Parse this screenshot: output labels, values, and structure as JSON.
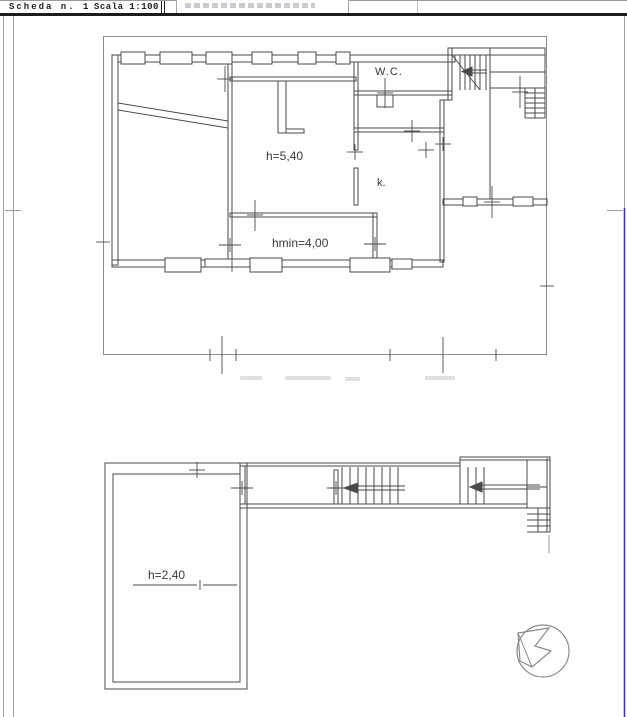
{
  "header": {
    "sheet_label": "Scheda n. 1",
    "scale_label": "Scala 1:100"
  },
  "upper_plan": {
    "title": "main floor plan",
    "labels": [
      {
        "id": "wc",
        "text": "W.C."
      },
      {
        "id": "height",
        "text": "h=5,40"
      },
      {
        "id": "kitchen",
        "text": "k."
      },
      {
        "id": "min_height",
        "text": "hmin=4,00"
      }
    ]
  },
  "lower_plan": {
    "title": "basement / attic plan",
    "labels": [
      {
        "id": "height",
        "text": "h=2,40"
      }
    ]
  },
  "icons": [
    {
      "name": "north-arrow-icon",
      "meaning": "north direction compass rose"
    }
  ],
  "colors": {
    "wall_line": "#4a4a4a",
    "boundary_line": "#8a8a8a",
    "frame_gray": "#a0a0a0",
    "frame_blue": "#3a3aa2",
    "header_rule": "#1c1c1c"
  }
}
